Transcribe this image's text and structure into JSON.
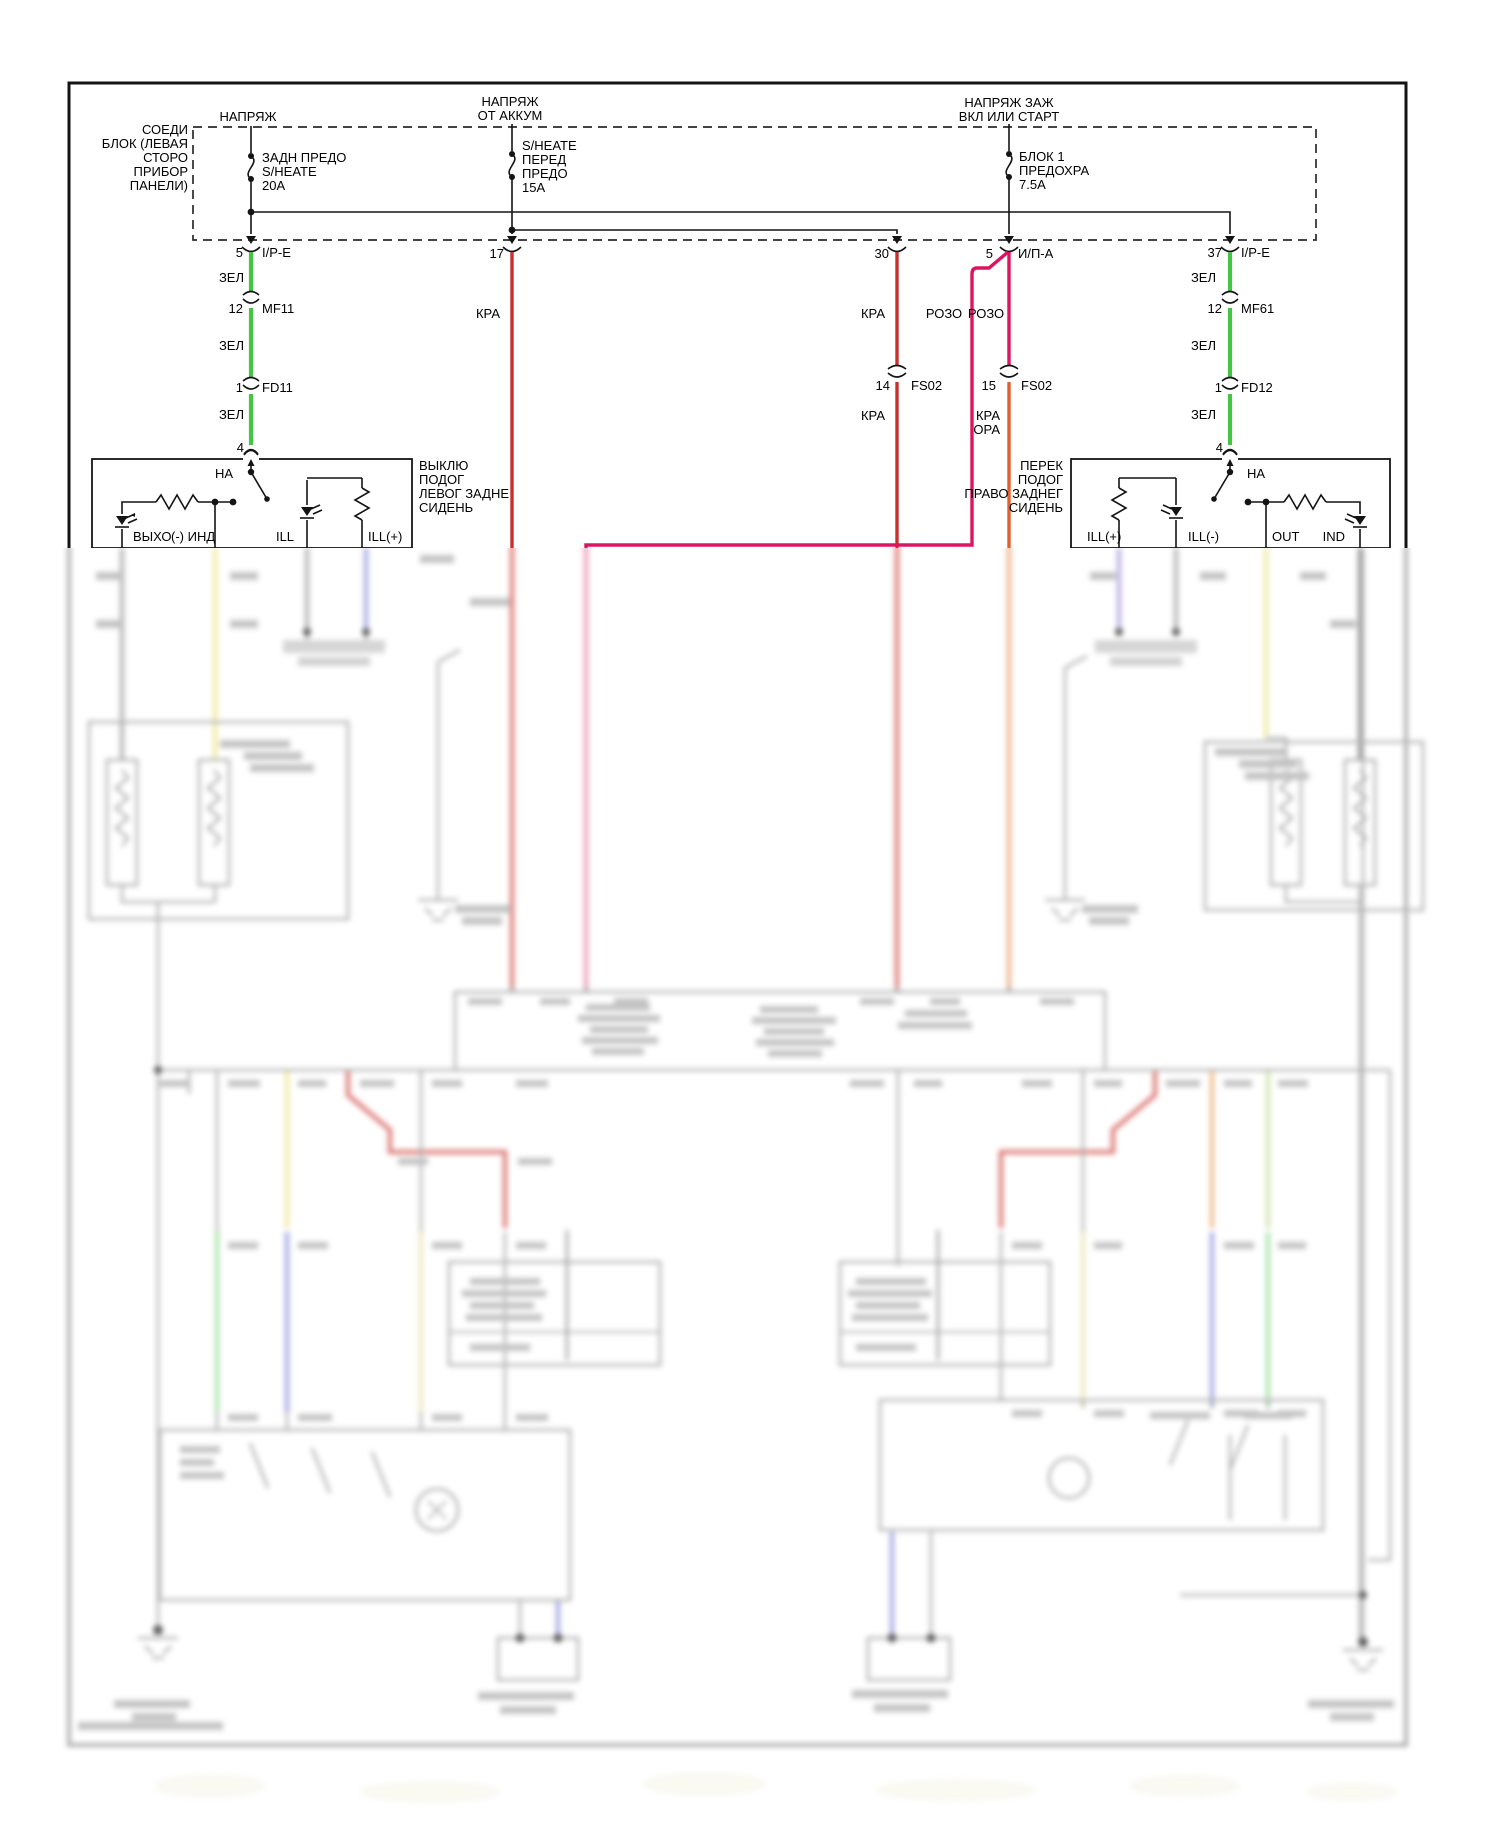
{
  "diagram_type": "automotive heated-seat wiring diagram (Russian labels), lower portion out of focus",
  "colors": {
    "wire_green": "#44c544",
    "wire_red": "#c9302c",
    "wire_pink": "#dc1560",
    "wire_orange": "#e2602e",
    "wire_yellow_blur": "#ece384",
    "wire_blue_blur": "#8b8bdb",
    "wire_purple_blur": "#a091d8",
    "line_black": "#141414",
    "blur_gray": "#909090"
  },
  "supplies": {
    "s1": "НАПРЯЖ",
    "s2a": "НАПРЯЖ",
    "s2b": "ОТ АККУМ",
    "s3a": "НАПРЯЖ ЗАЖ",
    "s3b": "ВКЛ ИЛИ СТАРТ"
  },
  "junction_block": {
    "l1": "СОЕДИ",
    "l2": "БЛОК (ЛЕВАЯ",
    "l3": "СТОРО",
    "l4": "ПРИБОР",
    "l5": "ПАНЕЛИ)"
  },
  "fuses": {
    "f1": {
      "l1": "ЗАДН ПРЕДО",
      "l2": "S/HEATE",
      "l3": "20A"
    },
    "f2": {
      "l1": "S/HEATE",
      "l2": "ПЕРЕД",
      "l3": "ПРЕДО",
      "l4": "15A"
    },
    "f3": {
      "l1": "БЛОК 1",
      "l2": "ПРЕДОХРА",
      "l3": "7.5A"
    }
  },
  "connectors": {
    "c5l_pin": "5",
    "c5l_name": "I/P-E",
    "c17_pin": "17",
    "c30_pin": "30",
    "c5r_pin": "5",
    "c5r_name": "И/П-А",
    "c37_pin": "37",
    "c37_name": "I/P-E",
    "mf11_pin": "12",
    "mf11_name": "MF11",
    "mf61_pin": "12",
    "mf61_name": "MF61",
    "fd11_pin": "1",
    "fd11_name": "FD11",
    "fd12_pin": "1",
    "fd12_name": "FD12",
    "fs14_pin": "14",
    "fs14_name": "FS02",
    "fs15_pin": "15",
    "fs15_name": "FS02",
    "t4": "4"
  },
  "wire_labels": {
    "zel": "ЗЕЛ",
    "kra": "КРА",
    "rozo": "РОЗО",
    "ora": "ОРА",
    "na": "НА"
  },
  "left_switch": {
    "t1": "ВЫКЛЮ",
    "t2": "ПОДОГ",
    "t3": "ЛЕВОГ ЗАДНЕ",
    "t4": "СИДЕНЬ",
    "p1": "ВЫХО",
    "p2": "(-) ИНД",
    "p3": "ILL",
    "p4": "ILL(+)"
  },
  "right_switch": {
    "t1": "ПЕРЕК",
    "t2": "ПОДОГ",
    "t3": "ПРАВО ЗАДНЕГ",
    "t4": "СИДЕНЬ",
    "p1": "ILL(+)",
    "p2": "ILL(-)",
    "p3": "OUT",
    "p4": "IND"
  }
}
